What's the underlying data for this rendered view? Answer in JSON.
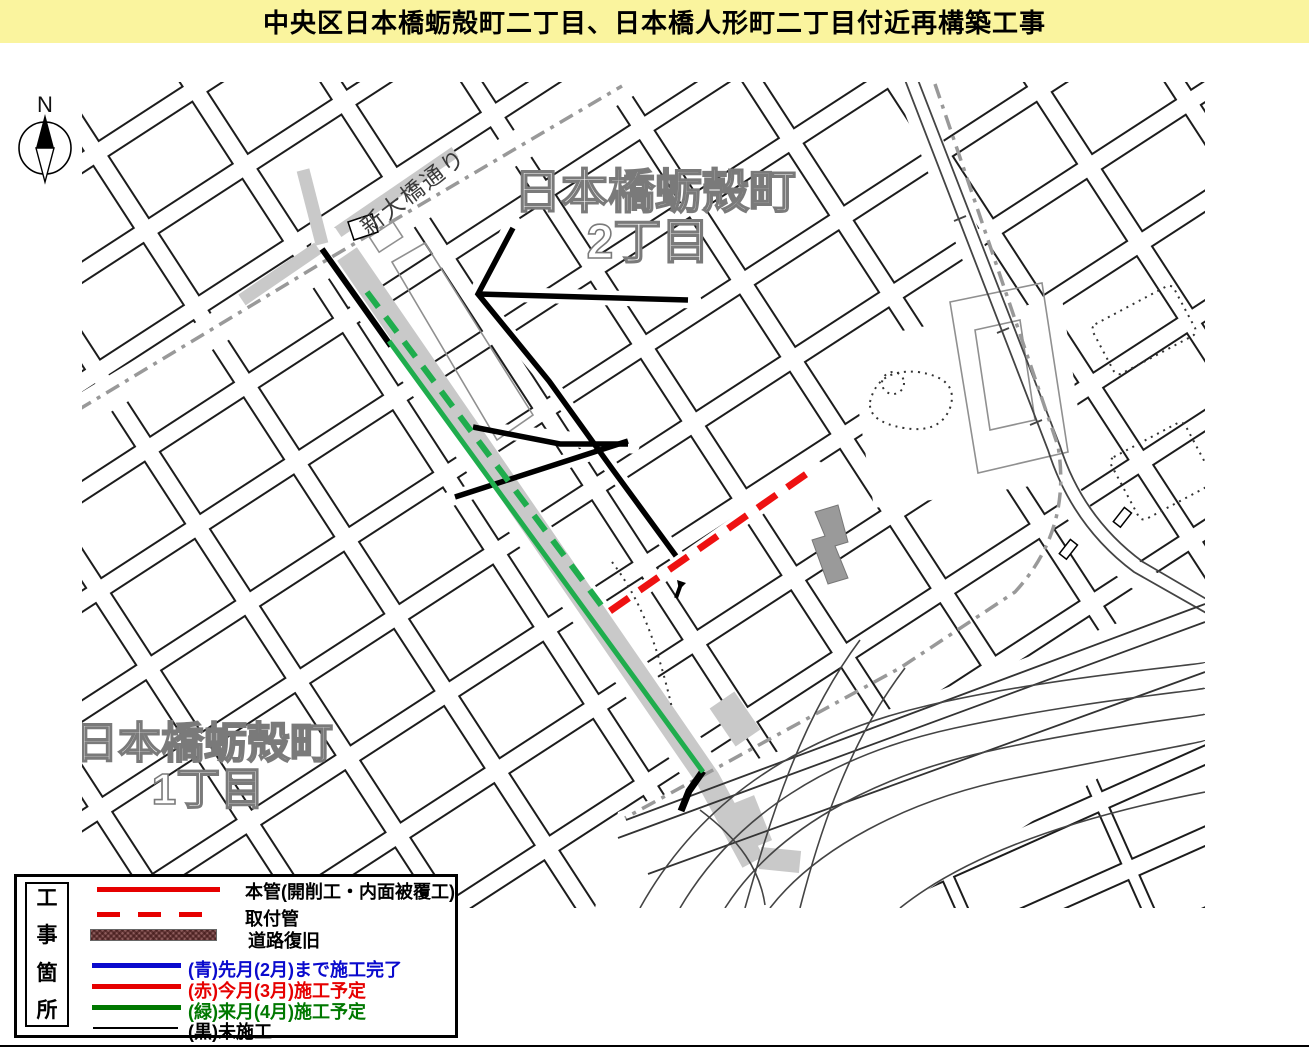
{
  "title": "中央区日本橋蛎殻町二丁目、日本橋人形町二丁目付近再構築工事",
  "compass": {
    "north_label": "N"
  },
  "map": {
    "street_label": "新大橋通り",
    "district_upper": {
      "line1": "日本橋蛎殻町",
      "line2": "2丁目"
    },
    "district_lower": {
      "line1": "日本橋蛎殻町",
      "line2": "1丁目"
    }
  },
  "legend": {
    "vertical_title_chars": [
      "工",
      "事",
      "箇",
      "所"
    ],
    "symbol_items": [
      {
        "label": "本管(開削工・内面被覆工)",
        "swatch": "thick-red-line",
        "color": "#e60000"
      },
      {
        "label": "取付管",
        "swatch": "dashed-red-line",
        "color": "#e60000"
      },
      {
        "label": "道路復旧",
        "swatch": "hatched-brown-bar",
        "color": "#8b5a5a"
      }
    ],
    "status_items": [
      {
        "label": "(青)先月(2月)まで施工完了",
        "color": "#0a0acd"
      },
      {
        "label": "(赤)今月(3月)施工予定",
        "color": "#e60000"
      },
      {
        "label": "(緑)来月(4月)施工予定",
        "color": "#007800"
      },
      {
        "label": "(黒)未施工",
        "color": "#000000"
      }
    ]
  },
  "map_line_colors": {
    "completed_blue": "#0a0acd",
    "planned_this_month_red": "#ee1111",
    "planned_next_month_green": "#1fad4d",
    "unbuilt_black": "#000000",
    "road_restoration_gray": "#c9c9c9"
  }
}
